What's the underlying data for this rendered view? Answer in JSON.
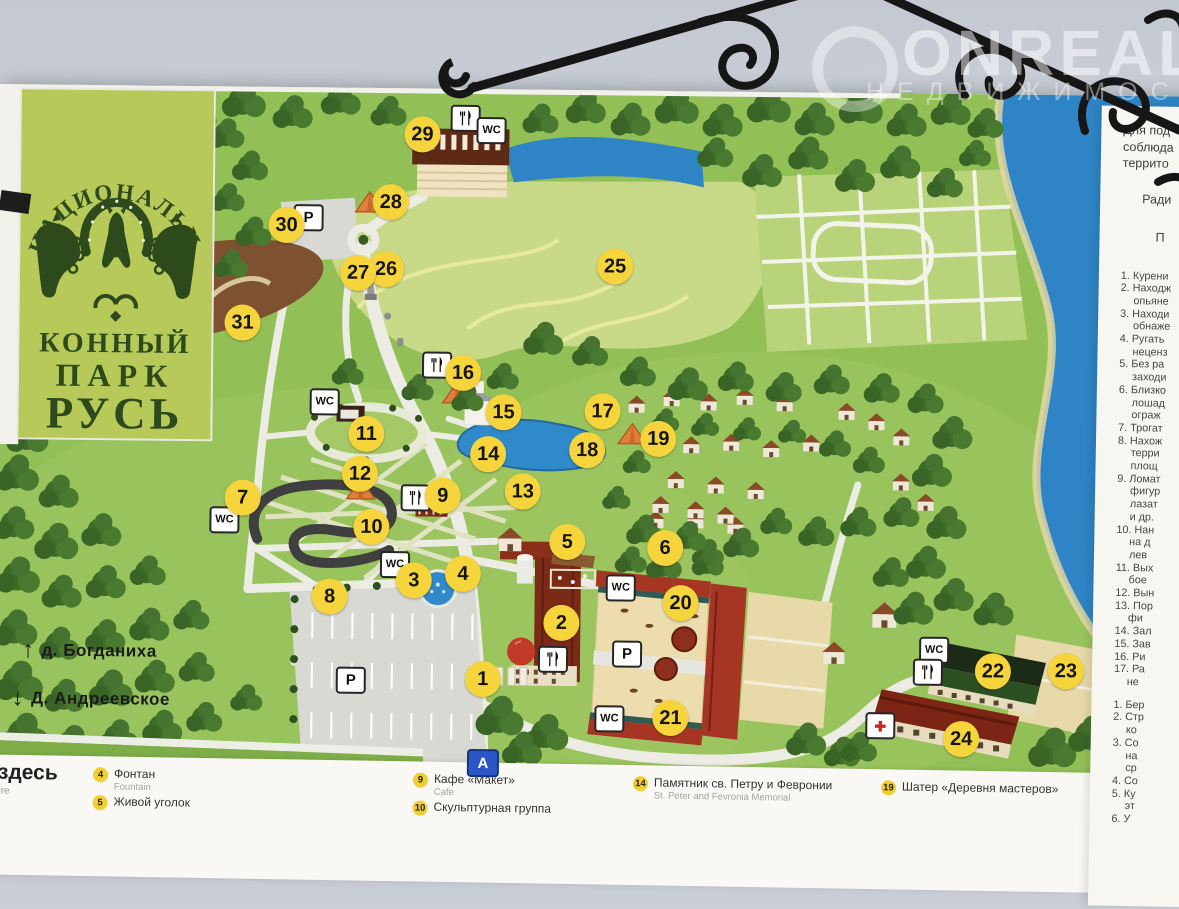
{
  "watermark": {
    "brand": "ONREAL",
    "subtitle": "НЕДВИЖИМОСТЬ"
  },
  "logo": {
    "arc": "НАЦИОНАЛЬНЫЙ",
    "word1": "КОННЫЙ",
    "word2": "ПАРК",
    "word3": "РУСЬ"
  },
  "colors": {
    "marker": "#f6d53c",
    "water": "#2e84c4",
    "grass": "#92c057",
    "logo_panel": "#b7c958",
    "logo_ink": "#2c4a1c"
  },
  "map": {
    "markers": [
      {
        "n": "1",
        "x": 489,
        "y": 590
      },
      {
        "n": "2",
        "x": 567,
        "y": 533
      },
      {
        "n": "3",
        "x": 419,
        "y": 492
      },
      {
        "n": "4",
        "x": 468,
        "y": 485
      },
      {
        "n": "5",
        "x": 572,
        "y": 452
      },
      {
        "n": "6",
        "x": 670,
        "y": 457
      },
      {
        "n": "7",
        "x": 247,
        "y": 411
      },
      {
        "n": "8",
        "x": 335,
        "y": 509
      },
      {
        "n": "9",
        "x": 447,
        "y": 407
      },
      {
        "n": "10",
        "x": 376,
        "y": 439
      },
      {
        "n": "11",
        "x": 370,
        "y": 346
      },
      {
        "n": "12",
        "x": 364,
        "y": 386
      },
      {
        "n": "13",
        "x": 527,
        "y": 402
      },
      {
        "n": "14",
        "x": 492,
        "y": 365
      },
      {
        "n": "15",
        "x": 507,
        "y": 323
      },
      {
        "n": "16",
        "x": 466,
        "y": 284
      },
      {
        "n": "17",
        "x": 606,
        "y": 321
      },
      {
        "n": "18",
        "x": 591,
        "y": 360
      },
      {
        "n": "19",
        "x": 662,
        "y": 348
      },
      {
        "n": "20",
        "x": 686,
        "y": 512
      },
      {
        "n": "21",
        "x": 677,
        "y": 627
      },
      {
        "n": "22",
        "x": 999,
        "y": 577
      },
      {
        "n": "23",
        "x": 1072,
        "y": 576
      },
      {
        "n": "24",
        "x": 968,
        "y": 645
      },
      {
        "n": "25",
        "x": 617,
        "y": 176
      },
      {
        "n": "26",
        "x": 388,
        "y": 181
      },
      {
        "n": "27",
        "x": 360,
        "y": 185
      },
      {
        "n": "28",
        "x": 392,
        "y": 114
      },
      {
        "n": "29",
        "x": 423,
        "y": 46
      },
      {
        "n": "30",
        "x": 288,
        "y": 138
      },
      {
        "n": "31",
        "x": 245,
        "y": 236
      }
    ],
    "signs": [
      {
        "t": "fork",
        "x": 464,
        "y": 28
      },
      {
        "t": "wc",
        "x": 490,
        "y": 40
      },
      {
        "t": "p",
        "x": 308,
        "y": 129
      },
      {
        "t": "wc",
        "x": 326,
        "y": 313
      },
      {
        "t": "fork",
        "x": 438,
        "y": 275
      },
      {
        "t": "fork",
        "x": 418,
        "y": 408
      },
      {
        "t": "wc",
        "x": 227,
        "y": 432
      },
      {
        "t": "wc",
        "x": 398,
        "y": 475
      },
      {
        "t": "wc",
        "x": 624,
        "y": 496
      },
      {
        "t": "p",
        "x": 631,
        "y": 562
      },
      {
        "t": "wc",
        "x": 614,
        "y": 627
      },
      {
        "t": "fork",
        "x": 557,
        "y": 568
      },
      {
        "t": "p",
        "x": 355,
        "y": 591
      },
      {
        "t": "bus",
        "x": 487,
        "y": 672
      },
      {
        "t": "wc",
        "x": 938,
        "y": 555
      },
      {
        "t": "fork",
        "x": 932,
        "y": 577
      },
      {
        "t": "med",
        "x": 885,
        "y": 631
      }
    ],
    "sign_labels": {
      "wc": "WC",
      "p": "P",
      "bus": "A",
      "med": "✚"
    },
    "villages": [
      {
        "label": "д. Богданиха",
        "x": 28,
        "y": 556,
        "dir": "up"
      },
      {
        "label": "Д. Андреевское",
        "x": 18,
        "y": 604,
        "dir": "down"
      }
    ]
  },
  "legend": {
    "here_ru": "Вы здесь",
    "here_en": "You are here",
    "items": [
      {
        "num": "4",
        "ru": "Фонтан",
        "en": "Fountain",
        "col": 0,
        "row": 0
      },
      {
        "num": "5",
        "ru": "Живой уголок",
        "en": "",
        "col": 0,
        "row": 1
      },
      {
        "num": "9",
        "ru": "Кафе «Макет»",
        "en": "Cafe",
        "col": 1,
        "row": 0
      },
      {
        "num": "10",
        "ru": "Скульптурная группа",
        "en": "",
        "col": 1,
        "row": 1
      },
      {
        "num": "14",
        "ru": "Памятник св. Петру и Февронии",
        "en": "St. Peter and Fevronia Memorial",
        "col": 2,
        "row": 0
      },
      {
        "num": "19",
        "ru": "Шатер «Деревня мастеров»",
        "en": "",
        "col": 3,
        "row": 0
      }
    ]
  },
  "rules": {
    "header": [
      "Для под",
      "соблюда",
      "террито"
    ],
    "mid": "Ради",
    "title": "П",
    "list1": [
      "1. Курени",
      "2. Находж",
      "опьяне",
      "3. Находи",
      "обнаже",
      "4. Ругать",
      "неценз",
      "5. Без ра",
      "заходи",
      "6. Близко",
      "лошад",
      "ограж",
      "7. Трогат",
      "8. Нахож",
      "терри",
      "площ",
      "9. Ломат",
      "фигур",
      "лазат",
      "и др.",
      "10. Нан",
      "на д",
      "лев",
      "11. Вых",
      "бое",
      "12. Вын",
      "13. Пор",
      "фи",
      "14. Зал",
      "15. Зав",
      "16. Ри",
      "17. Ра",
      "не"
    ],
    "list2": [
      "1. Бер",
      "2. Стр",
      "ко",
      "3. Со",
      "на",
      "ср",
      "4. Со",
      "5. Ку",
      "эт",
      "6. У"
    ]
  }
}
